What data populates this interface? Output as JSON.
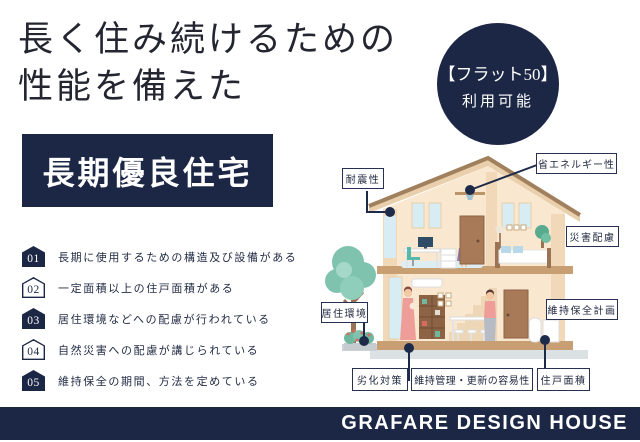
{
  "header": {
    "title_line1": "長く住み続けるための",
    "title_line2": "性能を備えた"
  },
  "flat50_badge": {
    "line1": "【フラット50】",
    "line2": "利用可能"
  },
  "headline": {
    "label": "長期優良住宅"
  },
  "features": {
    "items": [
      {
        "num": "01",
        "text": "長期に使用するための構造及び設備がある",
        "filled": true
      },
      {
        "num": "02",
        "text": "一定面積以上の住戸面積がある",
        "filled": false
      },
      {
        "num": "03",
        "text": "居住環境などへの配慮が行われている",
        "filled": true
      },
      {
        "num": "04",
        "text": "自然災害への配慮が講じられている",
        "filled": false
      },
      {
        "num": "05",
        "text": "維持保全の期間、方法を定めている",
        "filled": true
      }
    ]
  },
  "diagram": {
    "labels": [
      {
        "id": "taishinsei",
        "text": "耐震性"
      },
      {
        "id": "sho-energy",
        "text": "省エネルギー性"
      },
      {
        "id": "saigai-hairyo",
        "text": "災害配慮"
      },
      {
        "id": "iji-hozen-keikaku",
        "text": "維持保全計画"
      },
      {
        "id": "kyoju-kankyo",
        "text": "居住環境"
      },
      {
        "id": "rekka-taisaku",
        "text": "劣化対策"
      },
      {
        "id": "iji-kanri-koshin",
        "text": "維持管理・更新の容易性"
      },
      {
        "id": "juko-menseki",
        "text": "住戸面積"
      }
    ]
  },
  "footer": {
    "brand": "GRAFARE DESIGN HOUSE"
  },
  "colors": {
    "navy": "#1c2746",
    "wall": "#f9e8cf",
    "roof": "#e9cfab",
    "window_blue": "#d8ecf3",
    "tree_green": "#7fc3ae",
    "ground_gray": "#dce1e4"
  }
}
